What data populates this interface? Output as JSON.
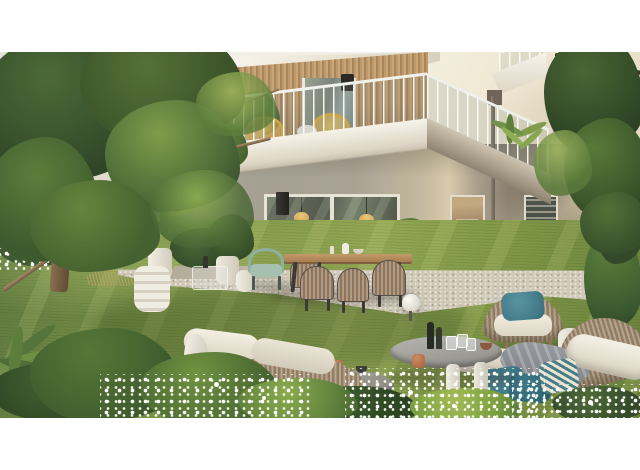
{
  "meta": {
    "media_type": "photorealistic architectural rendering",
    "subject": "modern residential building with wood-clad balcony above a garden terrace, outdoor lounge furniture in the foreground",
    "framing": "full-width image letterboxed with white bands top and bottom",
    "visible_text": "none"
  },
  "scene": {
    "background": {
      "left_building": "pale neighbouring facade glimpsed through large tree",
      "main_building_upper": "cream stucco facade, upper balcony with white soffit, vertical wood slat cladding, thin white railing bars, partial second-floor balcony corner top right"
    },
    "balcony": {
      "cladding": "vertical larch slats",
      "furniture": [
        "two yellow wire lounge chairs",
        "small white round table",
        "grey planter with shrub",
        "trailing plants over parapet"
      ],
      "fixture": "black wall sconce"
    },
    "ground_floor": {
      "wall": "greige stucco in balcony shadow, sunlit corner, tree-shadowed grey section right",
      "openings": [
        "small left window",
        "large glass sliding doors with two rattan pendant lamps visible inside",
        "glazed entrance door",
        "tall window with blinds",
        "second tall window behind foliage"
      ],
      "details": [
        "black wall sconce",
        "rain downpipe",
        "white planter with shrub at corner"
      ]
    },
    "terrace": {
      "floor": "light gravel with stone strip",
      "dining_set": [
        "wooden dining table with black legs",
        "four woven rope chairs",
        "white table decor"
      ],
      "seating": [
        "sage green metal armchair",
        "white drum side table",
        "glass side table with dark bottle"
      ],
      "planters": "white ceramic pots with palms and ferns",
      "lighting": "white sphere ground lamp"
    },
    "garden": {
      "lawn": "olive green grass with diagonal sun streaks",
      "beds": [
        "dark shrubs with tiny white flowers back left",
        "dry grass tuft",
        "fern and mixed shrubs foreground",
        "white flower sprays across foreground",
        "shrub against right wall"
      ]
    },
    "lounge_area": {
      "left_sofa": "rope-weave sofa with cream cushions and sculptural white vase",
      "tables": [
        "tall round grey coffee table with dark bottles, glasses and copper mugs",
        "lower round grey coffee table with copper mug and dark bowl"
      ],
      "armchair": "rope-weave armchair with cream cushion and teal pillow",
      "right_sofa": "rope-weave chaise and sofa with cream roll cushion, grey throw, two teal pillows and one patterned pillow",
      "accessories": [
        "white ceramic drum stool"
      ]
    },
    "trees": {
      "left": "large deciduous tree with pale arching branches filling the left edge",
      "right": "leafy tree canopy over the right facade"
    },
    "palette": {
      "letterbox": "#ffffff",
      "facade_cream": "#efe8d6",
      "soffit_white": "#f6f3ea",
      "wood_slats": "#b99a6e",
      "ground_wall_shade": "#a6a093",
      "ground_wall_sun": "#d8cbac",
      "glass_dark": "#565b50",
      "pendant_yellow": "#e3ba62",
      "chair_yellow": "#e7b546",
      "sage_green_chair": "#9db8a6",
      "gravel": "#d0c8b7",
      "lawn_green": "#7d9448",
      "foliage_dark": "#33492a",
      "foliage_light": "#8fae52",
      "rope_beige": "#b4a28a",
      "cushion_cream": "#efeadc",
      "pillow_teal": "#47808e",
      "throw_grey": "#8e9296",
      "copper_mug": "#b06f4a",
      "table_grey": "#9b978f"
    }
  }
}
